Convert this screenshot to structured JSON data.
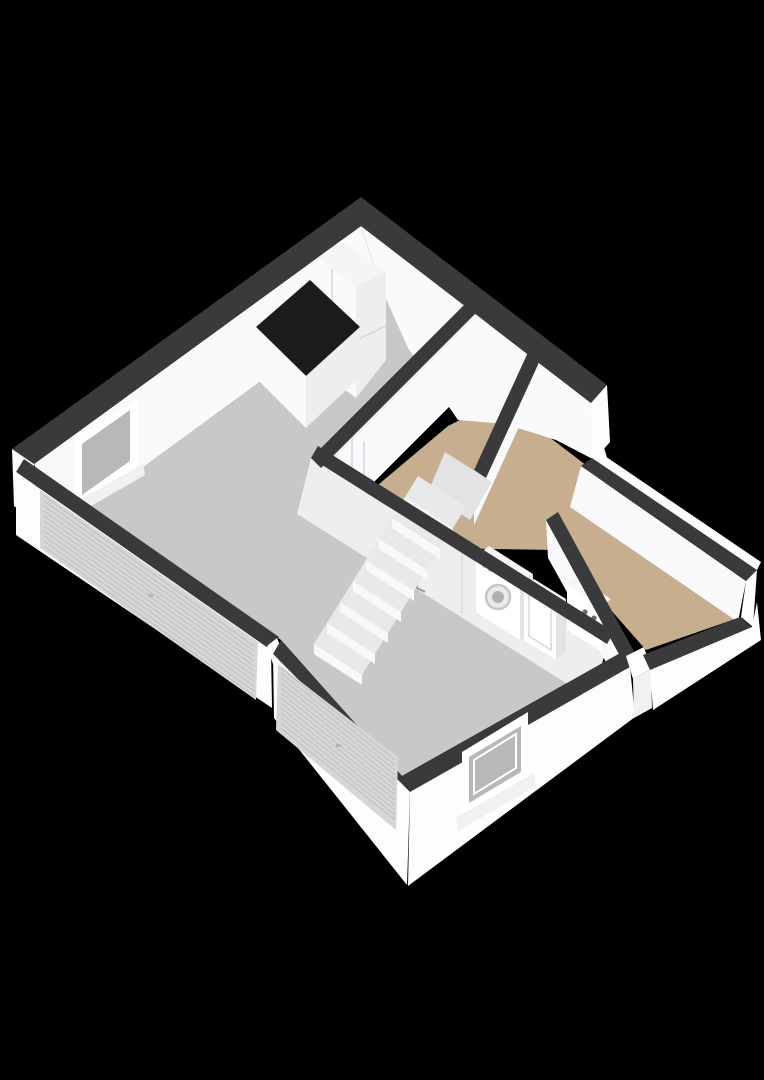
{
  "scene": {
    "title": "3D floor plan - ground floor",
    "view": "axonometric top-down, rotated 45 degrees",
    "background_label": "black backdrop"
  },
  "colors": {
    "background": "#000000",
    "wall_top": "#3a3a3c",
    "facade": "#fdfdfe",
    "facade_shade": "#f1f1f3",
    "interior_wall": "#fafafc",
    "interior_wall_shade": "#eeeef0",
    "floor_hard": "#c8c8ca",
    "floor_wood": "#c6ae8e",
    "counter_black": "#1c1c1e",
    "glass": "#b6b8ba",
    "roller_door": "#d6d6d8",
    "roller_line": "#bfbfc2",
    "appliance": "#f4f5f7",
    "appliance_side": "#e3e4e6",
    "step_tread": "#e9e9eb",
    "step_riser": "#f8f8fa",
    "winder": "#e3e3e5",
    "knob_dark": "#6a6a6e"
  },
  "rooms": [
    {
      "name": "garage-living-area",
      "floor_finish": "grey-concrete"
    },
    {
      "name": "stairwell",
      "floor_finish": "wood"
    },
    {
      "name": "entry-hallway",
      "floor_finish": "wood"
    }
  ],
  "features": [
    "staircase-eight-steps",
    "kitchen-tall-cabinet",
    "kitchen-counter-black-top",
    "washing-machine",
    "laundry-cabinet",
    "boiler-two-knobs",
    "interior-door-with-handle",
    "window-northwest-wall",
    "window-southeast-wall",
    "roller-garage-door-left",
    "roller-garage-door-front",
    "front-door-opening"
  ]
}
